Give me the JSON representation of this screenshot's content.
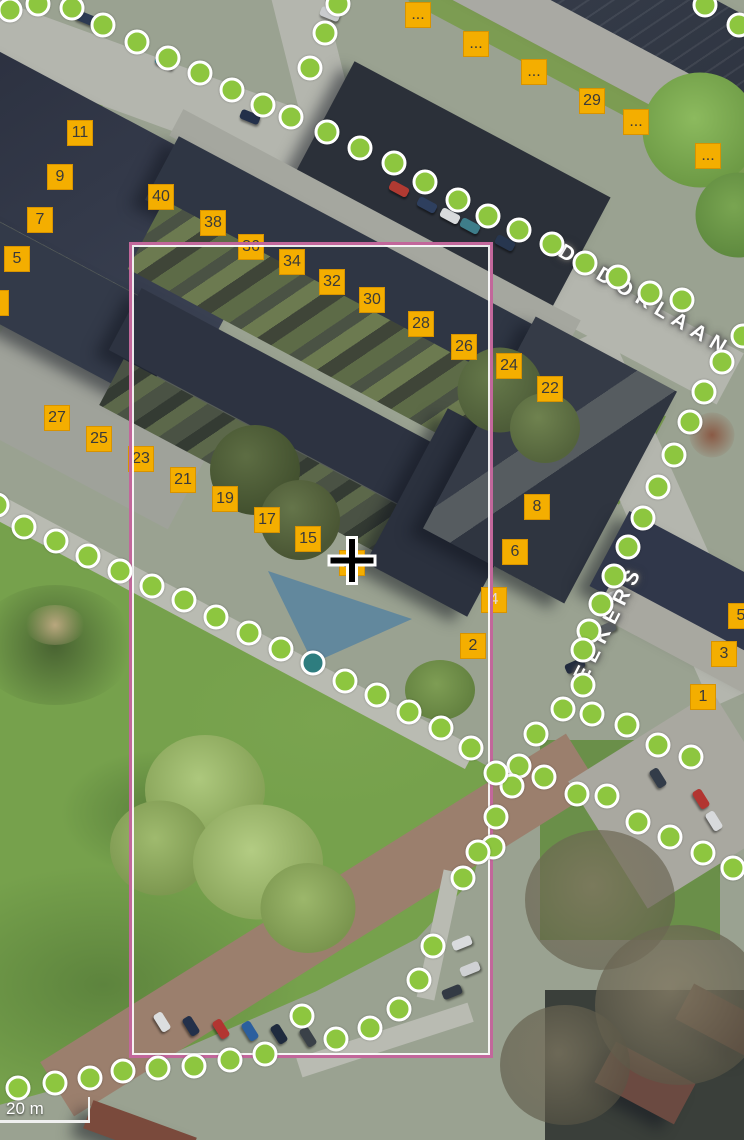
{
  "viewport": {
    "width": 744,
    "height": 1140
  },
  "scale_bar": {
    "label": "20 m"
  },
  "street_labels": [
    {
      "text": "DUDOKLAAN",
      "x": 560,
      "y": 238,
      "rotation": 31
    },
    {
      "text": "EEKERS",
      "x": 580,
      "y": 668,
      "rotation": -63
    }
  ],
  "selection_rectangle": {
    "left": 129,
    "top": 242,
    "width": 364,
    "height": 816,
    "stroke": "#c2679b"
  },
  "camera_cone": {
    "points": "313,663 268,571 412,619",
    "fill": "rgba(41,110,170,0.5)"
  },
  "selected_recording_point": {
    "x": 313,
    "y": 663,
    "color": "#2e7d7f"
  },
  "cursor": {
    "x": 352,
    "y": 563,
    "type": "crosshair-plus"
  },
  "recording_points": {
    "color": "#8dc63f",
    "border": "#ffffff",
    "points": [
      [
        10,
        10
      ],
      [
        38,
        4
      ],
      [
        72,
        8
      ],
      [
        103,
        25
      ],
      [
        137,
        42
      ],
      [
        168,
        58
      ],
      [
        200,
        73
      ],
      [
        232,
        90
      ],
      [
        263,
        105
      ],
      [
        291,
        117
      ],
      [
        310,
        68
      ],
      [
        325,
        33
      ],
      [
        338,
        4
      ],
      [
        327,
        132
      ],
      [
        360,
        148
      ],
      [
        394,
        163
      ],
      [
        425,
        182
      ],
      [
        458,
        200
      ],
      [
        488,
        216
      ],
      [
        519,
        230
      ],
      [
        552,
        244
      ],
      [
        585,
        263
      ],
      [
        618,
        277
      ],
      [
        650,
        293
      ],
      [
        682,
        300
      ],
      [
        705,
        5
      ],
      [
        739,
        25
      ],
      [
        743,
        336
      ],
      [
        722,
        362
      ],
      [
        704,
        392
      ],
      [
        690,
        422
      ],
      [
        674,
        455
      ],
      [
        658,
        487
      ],
      [
        643,
        518
      ],
      [
        628,
        547
      ],
      [
        614,
        576
      ],
      [
        601,
        604
      ],
      [
        589,
        631
      ],
      [
        583,
        650
      ],
      [
        583,
        685
      ],
      [
        563,
        709
      ],
      [
        592,
        714
      ],
      [
        536,
        734
      ],
      [
        627,
        725
      ],
      [
        519,
        766
      ],
      [
        544,
        777
      ],
      [
        512,
        786
      ],
      [
        496,
        773
      ],
      [
        607,
        796
      ],
      [
        577,
        794
      ],
      [
        496,
        817
      ],
      [
        493,
        847
      ],
      [
        478,
        852
      ],
      [
        463,
        878
      ],
      [
        -3,
        505
      ],
      [
        24,
        527
      ],
      [
        56,
        541
      ],
      [
        88,
        556
      ],
      [
        120,
        571
      ],
      [
        152,
        586
      ],
      [
        184,
        600
      ],
      [
        216,
        617
      ],
      [
        249,
        633
      ],
      [
        281,
        649
      ],
      [
        345,
        681
      ],
      [
        377,
        695
      ],
      [
        409,
        712
      ],
      [
        441,
        728
      ],
      [
        471,
        748
      ],
      [
        658,
        745
      ],
      [
        691,
        757
      ],
      [
        638,
        822
      ],
      [
        670,
        837
      ],
      [
        703,
        853
      ],
      [
        733,
        868
      ],
      [
        433,
        946
      ],
      [
        419,
        980
      ],
      [
        399,
        1009
      ],
      [
        370,
        1028
      ],
      [
        336,
        1039
      ],
      [
        302,
        1016
      ],
      [
        18,
        1088
      ],
      [
        55,
        1083
      ],
      [
        90,
        1078
      ],
      [
        123,
        1071
      ],
      [
        158,
        1068
      ],
      [
        194,
        1066
      ],
      [
        230,
        1060
      ],
      [
        265,
        1054
      ]
    ]
  },
  "house_numbers": {
    "bg": "#f4ae00",
    "border": "#d89300",
    "text_color": "#3a3a3a",
    "items": [
      {
        "text": "11",
        "x": 80,
        "y": 133
      },
      {
        "text": "9",
        "x": 60,
        "y": 177
      },
      {
        "text": "7",
        "x": 40,
        "y": 220
      },
      {
        "text": "5",
        "x": 17,
        "y": 259
      },
      {
        "text": "3",
        "x": -4,
        "y": 303
      },
      {
        "text": "40",
        "x": 161,
        "y": 197
      },
      {
        "text": "38",
        "x": 213,
        "y": 223
      },
      {
        "text": "36",
        "x": 251,
        "y": 247
      },
      {
        "text": "34",
        "x": 292,
        "y": 262
      },
      {
        "text": "32",
        "x": 332,
        "y": 282
      },
      {
        "text": "30",
        "x": 372,
        "y": 300
      },
      {
        "text": "28",
        "x": 421,
        "y": 324
      },
      {
        "text": "26",
        "x": 464,
        "y": 347
      },
      {
        "text": "24",
        "x": 509,
        "y": 366
      },
      {
        "text": "22",
        "x": 550,
        "y": 389
      },
      {
        "text": "29",
        "x": 592,
        "y": 101
      },
      {
        "text": "...",
        "x": 418,
        "y": 15
      },
      {
        "text": "...",
        "x": 476,
        "y": 44
      },
      {
        "text": "...",
        "x": 534,
        "y": 72
      },
      {
        "text": "...",
        "x": 636,
        "y": 122
      },
      {
        "text": "...",
        "x": 708,
        "y": 156
      },
      {
        "text": "27",
        "x": 57,
        "y": 418
      },
      {
        "text": "25",
        "x": 99,
        "y": 439
      },
      {
        "text": "23",
        "x": 141,
        "y": 459
      },
      {
        "text": "21",
        "x": 183,
        "y": 480
      },
      {
        "text": "19",
        "x": 225,
        "y": 499
      },
      {
        "text": "17",
        "x": 267,
        "y": 520
      },
      {
        "text": "15",
        "x": 308,
        "y": 539
      },
      {
        "text": "13",
        "x": 352,
        "y": 563,
        "variant": "under-cursor"
      },
      {
        "text": "8",
        "x": 537,
        "y": 507
      },
      {
        "text": "6",
        "x": 515,
        "y": 552
      },
      {
        "text": "4",
        "x": 494,
        "y": 600,
        "variant": "muted"
      },
      {
        "text": "2",
        "x": 473,
        "y": 646
      },
      {
        "text": "5",
        "x": 741,
        "y": 616
      },
      {
        "text": "3",
        "x": 724,
        "y": 654
      },
      {
        "text": "1",
        "x": 703,
        "y": 697
      }
    ]
  },
  "cars": [
    {
      "x": 399,
      "y": 189,
      "rot": 28,
      "color": "#b03a32"
    },
    {
      "x": 427,
      "y": 205,
      "rot": 28,
      "color": "#2e3f5e"
    },
    {
      "x": 450,
      "y": 216,
      "rot": 28,
      "color": "#d8dadc"
    },
    {
      "x": 470,
      "y": 226,
      "rot": 28,
      "color": "#3e7d8a"
    },
    {
      "x": 505,
      "y": 243,
      "rot": 28,
      "color": "#27364f"
    },
    {
      "x": 250,
      "y": 117,
      "rot": 22,
      "color": "#23304a"
    },
    {
      "x": 85,
      "y": 18,
      "rot": 22,
      "color": "#2c3a52"
    },
    {
      "x": 330,
      "y": 14,
      "rot": 22,
      "color": "#c9cbcd"
    },
    {
      "x": 165,
      "y": 62,
      "rot": 24,
      "color": "#3f7f8c"
    },
    {
      "x": 612,
      "y": 597,
      "rot": -24,
      "color": "#d9dbdd"
    },
    {
      "x": 606,
      "y": 629,
      "rot": -24,
      "color": "#5a6066"
    },
    {
      "x": 575,
      "y": 666,
      "rot": -24,
      "color": "#222c3f"
    },
    {
      "x": 658,
      "y": 778,
      "rot": 58,
      "color": "#333c49"
    },
    {
      "x": 701,
      "y": 799,
      "rot": 58,
      "color": "#b23531"
    },
    {
      "x": 714,
      "y": 821,
      "rot": 58,
      "color": "#d8dadc"
    },
    {
      "x": 162,
      "y": 1022,
      "rot": 58,
      "color": "#dcdedf"
    },
    {
      "x": 191,
      "y": 1026,
      "rot": 58,
      "color": "#23304a"
    },
    {
      "x": 221,
      "y": 1029,
      "rot": 58,
      "color": "#b23531"
    },
    {
      "x": 250,
      "y": 1031,
      "rot": 58,
      "color": "#2b5f9e"
    },
    {
      "x": 279,
      "y": 1034,
      "rot": 58,
      "color": "#1f2b3e"
    },
    {
      "x": 308,
      "y": 1037,
      "rot": 58,
      "color": "#3a4148"
    },
    {
      "x": 462,
      "y": 943,
      "rot": -22,
      "color": "#d9dbdd"
    },
    {
      "x": 470,
      "y": 969,
      "rot": -22,
      "color": "#cfd1d3"
    },
    {
      "x": 452,
      "y": 992,
      "rot": -22,
      "color": "#333a44"
    }
  ]
}
